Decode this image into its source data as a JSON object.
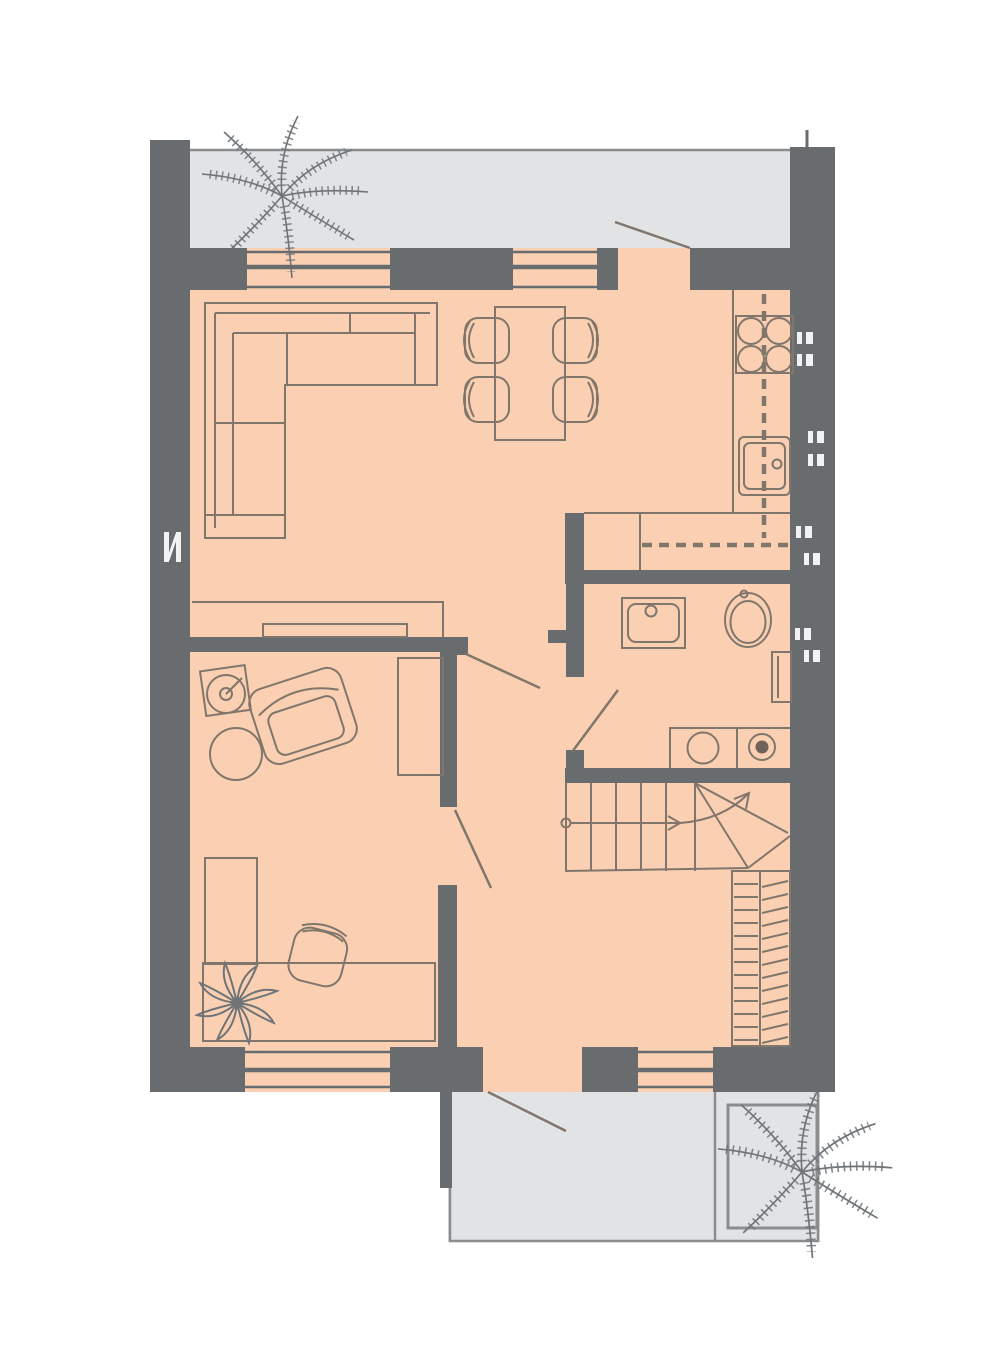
{
  "meta": {
    "title": "Residential floor plan — ground floor",
    "type": "architectural-floor-plan",
    "level": "entry level with staircase up"
  },
  "colors": {
    "background": "#ffffff",
    "wall": "#696c6e",
    "floor": "#fbd0b2",
    "terrace": "#e2e3e5",
    "terrace_border": "#8a8d8f",
    "furniture_line": "#80766b",
    "plant_line": "#6e7478",
    "wall_marker": "#f2f2f2",
    "appliance_dark": "#6e6259"
  },
  "plan": {
    "rooms": [
      {
        "name": "top-terrace",
        "type": "terrace",
        "features": [
          "palm-plant",
          "balcony-door-swing"
        ]
      },
      {
        "name": "living-dining-kitchen",
        "type": "open-living-area",
        "furniture": [
          "corner-sofa",
          "dining-table",
          "dining-chair x4",
          "tv-bench",
          "kitchen-counter",
          "cooktop-4-burner",
          "kitchen-sink",
          "overhead-cabinet-dashed"
        ]
      },
      {
        "name": "hall-closet",
        "type": "wardrobe-niche",
        "features": [
          "hanging-rod-dashed",
          "divider"
        ]
      },
      {
        "name": "bathroom-laundry",
        "type": "bathroom",
        "furniture": [
          "washbasin",
          "toilet",
          "radiator-shelf",
          "laundry-counter",
          "washing-machine",
          "dryer"
        ]
      },
      {
        "name": "bedroom-office",
        "type": "room",
        "furniture": [
          "floor-lamp",
          "side-table",
          "armchair",
          "wardrobe",
          "l-shaped-desk",
          "desk-chair",
          "flower-plant"
        ]
      },
      {
        "name": "entrance-hall",
        "type": "hall",
        "furniture": [
          "staircase-with-winder",
          "coat-closet-slatted"
        ]
      },
      {
        "name": "bottom-terrace",
        "type": "entrance-porch",
        "features": [
          "palm-planter",
          "entry-door-swing"
        ]
      }
    ],
    "windows": [
      {
        "wall": "north",
        "position": "living-room-left"
      },
      {
        "wall": "north",
        "position": "dining-area"
      },
      {
        "wall": "south",
        "position": "bedroom-office"
      },
      {
        "wall": "south",
        "position": "entrance-hall"
      }
    ],
    "doors": [
      {
        "name": "terrace-door",
        "between": [
          "living-area",
          "top-terrace"
        ]
      },
      {
        "name": "living-to-hall-door",
        "between": [
          "living-area",
          "hallway"
        ]
      },
      {
        "name": "bedroom-door",
        "between": [
          "bedroom-office",
          "entrance-hall"
        ]
      },
      {
        "name": "bathroom-door",
        "between": [
          "hallway",
          "bathroom-laundry"
        ]
      },
      {
        "name": "front-door",
        "between": [
          "entrance-hall",
          "bottom-terrace"
        ]
      }
    ],
    "stairs": {
      "direction": "up",
      "flight": "straight-then-winder-right",
      "treads_straight": 5,
      "start_marker": "circle",
      "arrow": "right-then-curving-up"
    },
    "wall_markers": {
      "right_wall_count": 8,
      "left_wall_count": 1,
      "style": "small white paired glyphs"
    }
  }
}
